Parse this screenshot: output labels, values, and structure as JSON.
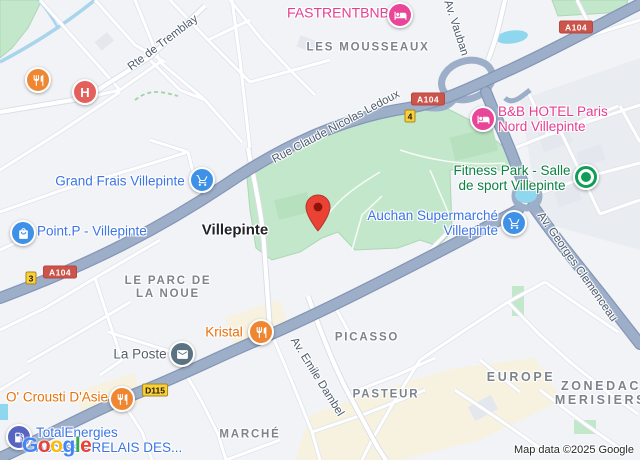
{
  "map": {
    "city_label": "Villepinte",
    "attribution": "Map data ©2025 Google",
    "logo": {
      "letters": [
        "G",
        "o",
        "o",
        "g",
        "l",
        "e"
      ]
    },
    "area_labels": [
      "LES MOUSSEAUX",
      "LE PARC DE\nLA NOUE",
      "PICASSO",
      "PASTEUR",
      "EUROPE",
      "ZONEDAC\nMERISIERS",
      "MARCHÉ"
    ],
    "road_labels": [
      "Rte de Tremblay",
      "Rue Claude Nicolas Ledoux",
      "Av. Vauban",
      "Av. Georges Clemenceau",
      "Av. Emile Dambel"
    ],
    "route_shields": [
      {
        "label": "A104",
        "kind": "autoroute"
      },
      {
        "label": "A104",
        "kind": "autoroute"
      },
      {
        "label": "A104",
        "kind": "autoroute"
      },
      {
        "label": "3",
        "kind": "local"
      },
      {
        "label": "4",
        "kind": "local"
      },
      {
        "label": "D115",
        "kind": "departmental"
      }
    ],
    "pois": [
      {
        "label": "FASTRENTBNB",
        "category": "hotel"
      },
      {
        "label": "B&B HOTEL Paris\nNord Villepinte",
        "category": "hotel"
      },
      {
        "label": "Grand Frais Villepinte",
        "category": "supermarket"
      },
      {
        "label": "Point.P - Villepinte",
        "category": "hardware-store"
      },
      {
        "label": "Auchan Supermarché\nVillepinte",
        "category": "supermarket"
      },
      {
        "label": "Fitness Park - Salle\nde sport Villepinte",
        "category": "gym"
      },
      {
        "label": "Kristal",
        "category": "restaurant"
      },
      {
        "label": "La Poste",
        "category": "post-office"
      },
      {
        "label": "O' Crousti D'Asie",
        "category": "restaurant"
      },
      {
        "label": "TotalEnergies\nAccess - RELAIS DES...",
        "category": "gas-station"
      },
      {
        "label": "",
        "category": "restaurant"
      },
      {
        "label": "",
        "category": "hospital"
      }
    ],
    "colors": {
      "park_green": "#c3e7cb",
      "water_blue": "#8fd7ee",
      "major_road": "#9daec9",
      "shield_red": "#cb544b",
      "shield_yellow": "#f9cf3c",
      "poi_blue_text": "#3d74e6",
      "poi_pink_text": "#e53e92",
      "poi_orange_text": "#e8710a",
      "poi_green_text": "#0c8043",
      "marker_red": "#ea4335"
    }
  }
}
